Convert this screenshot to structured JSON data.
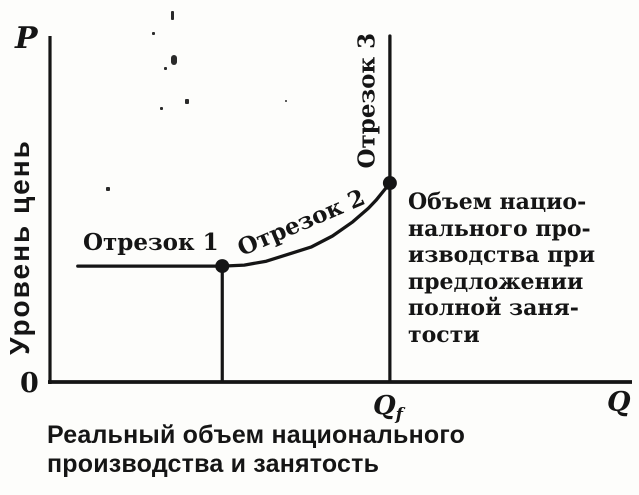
{
  "figure": {
    "background_color": "#fdfdfb",
    "ink_color": "#151515",
    "y_axis_symbol": "P",
    "y_axis_title": "Уровень цень",
    "origin_label": "0",
    "x_axis_symbol": "Q",
    "qf_label_base": "Q",
    "qf_label_sub": "f",
    "segment1_label": "Отрезок 1",
    "segment2_label": "Отрезок 2",
    "segment3_label": "Отрезок 3",
    "right_annotation": "Объем нацио-\nнального про-\nизводства при\nпредложении\nполной заня-\nтости",
    "caption": "Реальный объем национального\nпроизводства и занятость"
  },
  "chart_data": {
    "type": "line",
    "title": "",
    "xlabel": "Реальный объем национального производства и занятость",
    "ylabel": "Уровень цень",
    "x_axis_end_label": "Q",
    "y_axis_end_label": "P",
    "origin_label": "0",
    "grid": false,
    "legend": "none",
    "axis_ranges_normalized": {
      "x": [
        0,
        1
      ],
      "y": [
        0,
        1
      ]
    },
    "x_ticks": [
      {
        "label": "Qf",
        "x": 0.586
      }
    ],
    "segment_labels": [
      "Отрезок 1",
      "Отрезок 2",
      "Отрезок 3"
    ],
    "annotations": [
      "Объем национального производства при предложении полной занятости"
    ],
    "series": [
      {
        "name": "aggregate-supply-curve",
        "points_frac": [
          [
            0.048,
            0.335
          ],
          [
            0.297,
            0.335
          ],
          [
            0.335,
            0.338
          ],
          [
            0.373,
            0.349
          ],
          [
            0.45,
            0.39
          ],
          [
            0.487,
            0.422
          ],
          [
            0.522,
            0.463
          ],
          [
            0.549,
            0.502
          ],
          [
            0.562,
            0.525
          ],
          [
            0.586,
            0.575
          ],
          [
            0.586,
            1.0
          ]
        ]
      }
    ],
    "markers_frac": [
      [
        0.297,
        0.335
      ],
      [
        0.586,
        0.575
      ]
    ],
    "droplines_frac": [
      {
        "from": [
          0.297,
          0.335
        ],
        "to": [
          0.297,
          0.0
        ]
      },
      {
        "from": [
          0.586,
          0.575
        ],
        "to": [
          0.586,
          0.0
        ]
      }
    ]
  }
}
